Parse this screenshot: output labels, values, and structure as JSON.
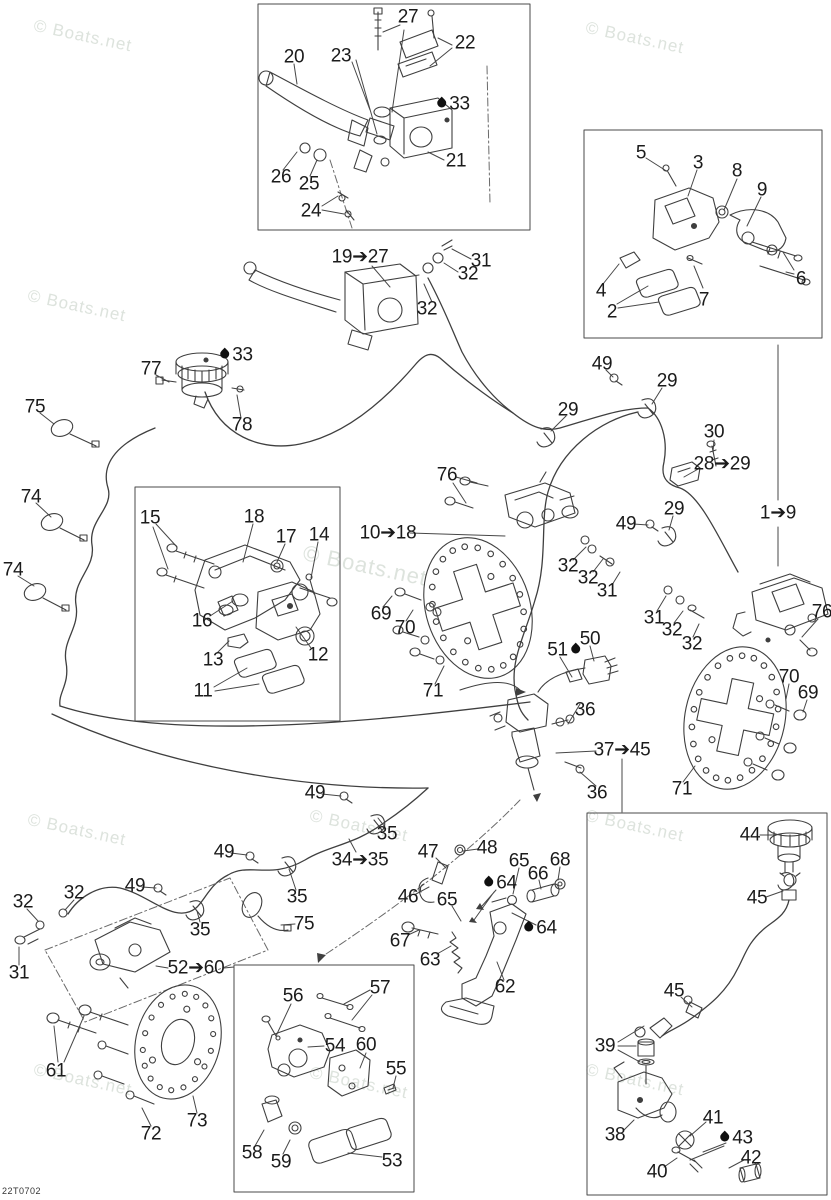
{
  "diagram_code": "22T0702",
  "watermark_text": "© Boats.net",
  "watermarks": [
    {
      "x": 36,
      "y": 16,
      "size": 17
    },
    {
      "x": 588,
      "y": 18,
      "size": 17
    },
    {
      "x": 30,
      "y": 286,
      "size": 17
    },
    {
      "x": 306,
      "y": 540,
      "size": 22
    },
    {
      "x": 30,
      "y": 810,
      "size": 17
    },
    {
      "x": 312,
      "y": 806,
      "size": 17
    },
    {
      "x": 588,
      "y": 806,
      "size": 17
    },
    {
      "x": 36,
      "y": 1060,
      "size": 17
    },
    {
      "x": 312,
      "y": 1063,
      "size": 17
    },
    {
      "x": 588,
      "y": 1060,
      "size": 17
    }
  ],
  "callouts": [
    {
      "label": "27",
      "x": 408,
      "y": 17
    },
    {
      "label": "22",
      "x": 465,
      "y": 43
    },
    {
      "label": "23",
      "x": 341,
      "y": 56
    },
    {
      "label": "20",
      "x": 294,
      "y": 57
    },
    {
      "label": "33",
      "x": 453,
      "y": 104,
      "drop": "left"
    },
    {
      "label": "21",
      "x": 456,
      "y": 161
    },
    {
      "label": "26",
      "x": 281,
      "y": 177
    },
    {
      "label": "25",
      "x": 309,
      "y": 184
    },
    {
      "label": "24",
      "x": 311,
      "y": 211
    },
    {
      "label": "19➔27",
      "x": 360,
      "y": 257
    },
    {
      "label": "31",
      "x": 481,
      "y": 261
    },
    {
      "label": "32",
      "x": 468,
      "y": 274
    },
    {
      "label": "32",
      "x": 427,
      "y": 309
    },
    {
      "label": "5",
      "x": 641,
      "y": 153
    },
    {
      "label": "3",
      "x": 698,
      "y": 163
    },
    {
      "label": "8",
      "x": 737,
      "y": 171
    },
    {
      "label": "9",
      "x": 762,
      "y": 190
    },
    {
      "label": "6",
      "x": 801,
      "y": 279
    },
    {
      "label": "4",
      "x": 601,
      "y": 291
    },
    {
      "label": "2",
      "x": 612,
      "y": 312
    },
    {
      "label": "7",
      "x": 704,
      "y": 300
    },
    {
      "label": "77",
      "x": 151,
      "y": 369
    },
    {
      "label": "33",
      "x": 236,
      "y": 355,
      "drop": "left"
    },
    {
      "label": "78",
      "x": 242,
      "y": 425
    },
    {
      "label": "75",
      "x": 35,
      "y": 407
    },
    {
      "label": "74",
      "x": 31,
      "y": 497
    },
    {
      "label": "74",
      "x": 13,
      "y": 570
    },
    {
      "label": "49",
      "x": 602,
      "y": 364
    },
    {
      "label": "29",
      "x": 667,
      "y": 381
    },
    {
      "label": "29",
      "x": 568,
      "y": 410
    },
    {
      "label": "30",
      "x": 714,
      "y": 432
    },
    {
      "label": "28➔29",
      "x": 722,
      "y": 464
    },
    {
      "label": "76",
      "x": 447,
      "y": 475
    },
    {
      "label": "1➔9",
      "x": 778,
      "y": 513
    },
    {
      "label": "49",
      "x": 626,
      "y": 524
    },
    {
      "label": "29",
      "x": 674,
      "y": 509
    },
    {
      "label": "15",
      "x": 150,
      "y": 518
    },
    {
      "label": "18",
      "x": 254,
      "y": 517
    },
    {
      "label": "17",
      "x": 286,
      "y": 537
    },
    {
      "label": "14",
      "x": 319,
      "y": 535
    },
    {
      "label": "10➔18",
      "x": 388,
      "y": 533
    },
    {
      "label": "16",
      "x": 202,
      "y": 621
    },
    {
      "label": "13",
      "x": 213,
      "y": 660
    },
    {
      "label": "12",
      "x": 318,
      "y": 655
    },
    {
      "label": "11",
      "x": 203,
      "y": 691
    },
    {
      "label": "32",
      "x": 568,
      "y": 566
    },
    {
      "label": "32",
      "x": 588,
      "y": 578
    },
    {
      "label": "31",
      "x": 607,
      "y": 591
    },
    {
      "label": "69",
      "x": 381,
      "y": 614
    },
    {
      "label": "70",
      "x": 405,
      "y": 628
    },
    {
      "label": "71",
      "x": 433,
      "y": 691
    },
    {
      "label": "51",
      "x": 564,
      "y": 650,
      "drop": "right"
    },
    {
      "label": "50",
      "x": 590,
      "y": 639
    },
    {
      "label": "36",
      "x": 585,
      "y": 710
    },
    {
      "label": "37➔45",
      "x": 622,
      "y": 750
    },
    {
      "label": "36",
      "x": 597,
      "y": 793
    },
    {
      "label": "31",
      "x": 654,
      "y": 618
    },
    {
      "label": "32",
      "x": 672,
      "y": 630
    },
    {
      "label": "32",
      "x": 692,
      "y": 644
    },
    {
      "label": "76",
      "x": 822,
      "y": 612
    },
    {
      "label": "70",
      "x": 789,
      "y": 677
    },
    {
      "label": "69",
      "x": 808,
      "y": 693
    },
    {
      "label": "71",
      "x": 682,
      "y": 789
    },
    {
      "label": "49",
      "x": 315,
      "y": 793
    },
    {
      "label": "35",
      "x": 387,
      "y": 834
    },
    {
      "label": "34➔35",
      "x": 360,
      "y": 860
    },
    {
      "label": "49",
      "x": 224,
      "y": 852
    },
    {
      "label": "35",
      "x": 297,
      "y": 897
    },
    {
      "label": "49",
      "x": 135,
      "y": 886
    },
    {
      "label": "35",
      "x": 200,
      "y": 930
    },
    {
      "label": "75",
      "x": 304,
      "y": 924
    },
    {
      "label": "32",
      "x": 23,
      "y": 902
    },
    {
      "label": "32",
      "x": 74,
      "y": 893
    },
    {
      "label": "31",
      "x": 19,
      "y": 973
    },
    {
      "label": "52➔60",
      "x": 196,
      "y": 968
    },
    {
      "label": "61",
      "x": 56,
      "y": 1071
    },
    {
      "label": "72",
      "x": 151,
      "y": 1134
    },
    {
      "label": "73",
      "x": 197,
      "y": 1121
    },
    {
      "label": "56",
      "x": 293,
      "y": 996
    },
    {
      "label": "57",
      "x": 380,
      "y": 988
    },
    {
      "label": "54",
      "x": 335,
      "y": 1046
    },
    {
      "label": "60",
      "x": 366,
      "y": 1045
    },
    {
      "label": "55",
      "x": 396,
      "y": 1069
    },
    {
      "label": "58",
      "x": 252,
      "y": 1153
    },
    {
      "label": "59",
      "x": 281,
      "y": 1162
    },
    {
      "label": "53",
      "x": 392,
      "y": 1161
    },
    {
      "label": "47",
      "x": 428,
      "y": 852
    },
    {
      "label": "48",
      "x": 487,
      "y": 848
    },
    {
      "label": "65",
      "x": 519,
      "y": 861
    },
    {
      "label": "68",
      "x": 560,
      "y": 860
    },
    {
      "label": "66",
      "x": 538,
      "y": 874
    },
    {
      "label": "46",
      "x": 408,
      "y": 897
    },
    {
      "label": "64",
      "x": 500,
      "y": 883,
      "drop": "left"
    },
    {
      "label": "65",
      "x": 447,
      "y": 900
    },
    {
      "label": "67",
      "x": 400,
      "y": 941
    },
    {
      "label": "64",
      "x": 540,
      "y": 928,
      "drop": "left"
    },
    {
      "label": "63",
      "x": 430,
      "y": 960
    },
    {
      "label": "62",
      "x": 505,
      "y": 987
    },
    {
      "label": "44",
      "x": 750,
      "y": 835
    },
    {
      "label": "45",
      "x": 757,
      "y": 898
    },
    {
      "label": "45",
      "x": 674,
      "y": 991
    },
    {
      "label": "39",
      "x": 605,
      "y": 1046
    },
    {
      "label": "38",
      "x": 615,
      "y": 1135
    },
    {
      "label": "41",
      "x": 713,
      "y": 1118
    },
    {
      "label": "43",
      "x": 736,
      "y": 1138,
      "drop": "left"
    },
    {
      "label": "40",
      "x": 657,
      "y": 1172
    },
    {
      "label": "42",
      "x": 751,
      "y": 1158
    }
  ]
}
